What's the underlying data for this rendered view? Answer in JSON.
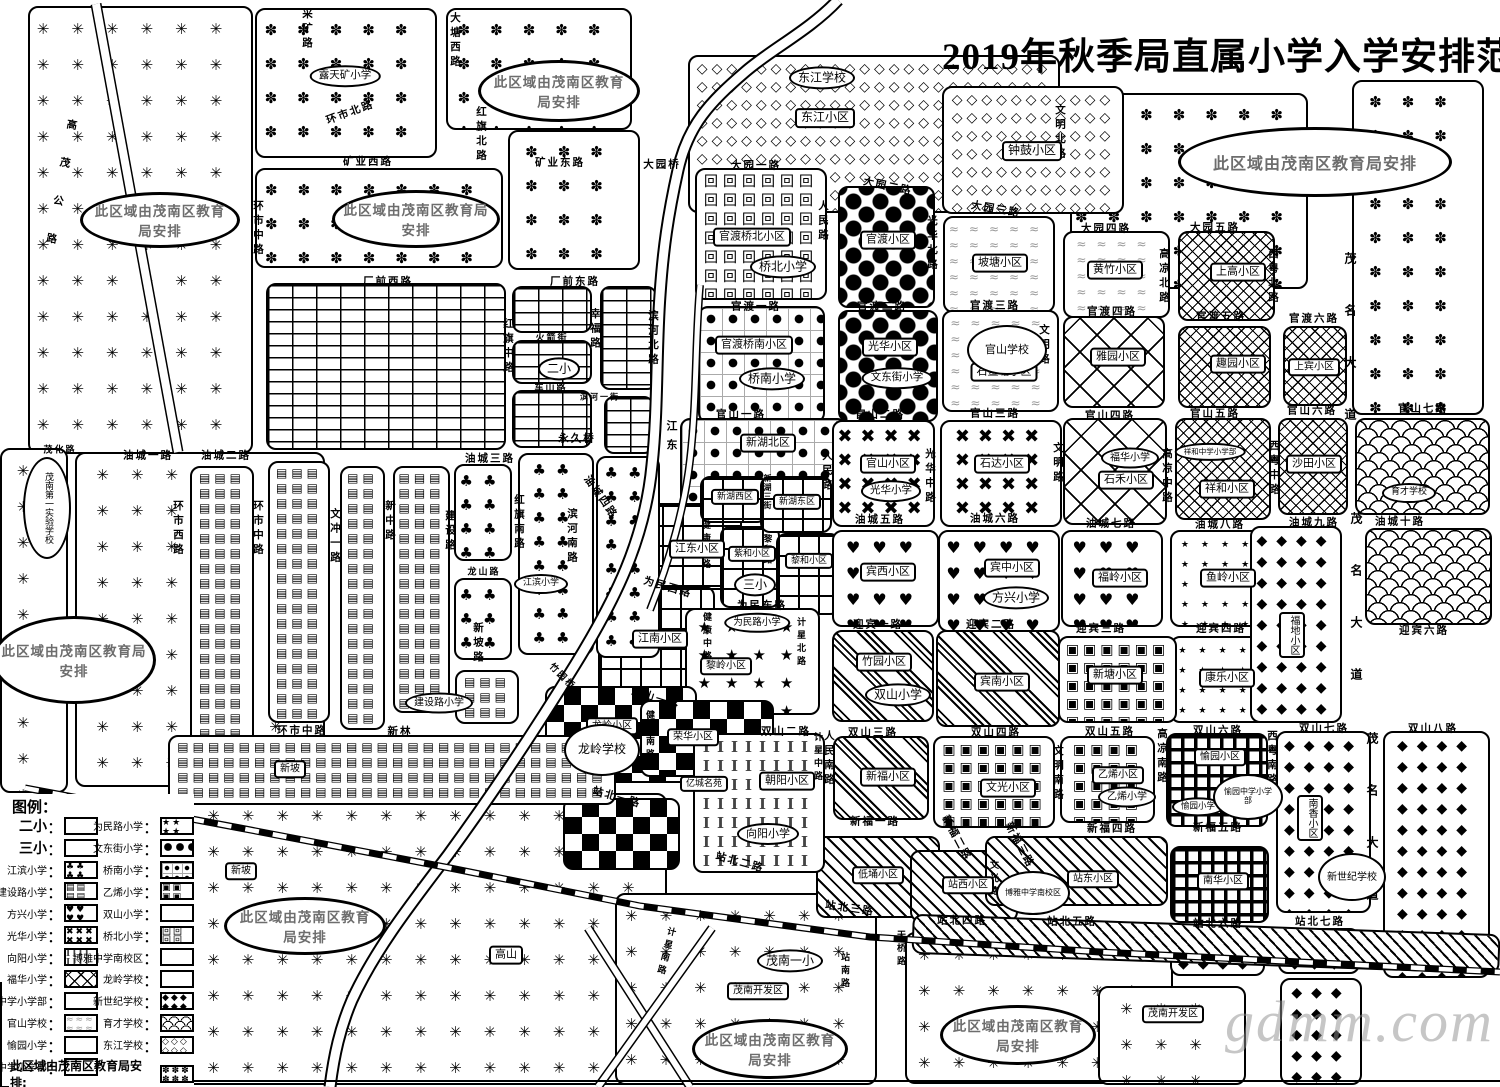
{
  "title": "2019年秋季局直属小学入学安排范围图",
  "watermark": "gdmm.com",
  "district_note": "此区域由茂南区教育局安排",
  "legend": {
    "title": "图例：",
    "colon": "：",
    "footer": "此区域由茂南区教育局安排:",
    "left": [
      {
        "label": "二小",
        "pattern": "brick"
      },
      {
        "label": "三小",
        "pattern": "grid-plaid"
      },
      {
        "label": "江滨小学",
        "pattern": "maple-club"
      },
      {
        "label": "建设路小学",
        "pattern": "bar-blocks"
      },
      {
        "label": "方兴小学",
        "pattern": "hearts"
      },
      {
        "label": "光华小学",
        "pattern": "crosses"
      },
      {
        "label": "向阳小学",
        "pattern": "i-beam"
      },
      {
        "label": "福华小学",
        "pattern": "diamond-lattice"
      },
      {
        "label": "祥和中学小学部",
        "pattern": "dense-crosshatch"
      },
      {
        "label": "官山学校",
        "pattern": "wiggle"
      },
      {
        "label": "愉园小学",
        "pattern": "basket-weave"
      },
      {
        "label": "愉园中学小学部",
        "pattern": "small-dots"
      }
    ],
    "right": [
      {
        "label": "为民路小学",
        "pattern": "stars"
      },
      {
        "label": "文东街小学",
        "pattern": "big-dots"
      },
      {
        "label": "桥南小学",
        "pattern": "octagon-dots"
      },
      {
        "label": "乙烯小学",
        "pattern": "concentric-squares"
      },
      {
        "label": "双山小学",
        "pattern": "group-stripes"
      },
      {
        "label": "桥北小学",
        "pattern": "greek-key"
      },
      {
        "label": "博雅中学南校区",
        "pattern": "diagonal-hatch"
      },
      {
        "label": "龙岭学校",
        "pattern": "checkerboard"
      },
      {
        "label": "新世纪学校",
        "pattern": "black-diamonds"
      },
      {
        "label": "育才学校",
        "pattern": "fish-scales"
      },
      {
        "label": "东江学校",
        "pattern": "circle-chain"
      }
    ]
  },
  "ovals": [
    "露天矿小学",
    "东江学校",
    "桥北小学",
    "桥南小学",
    "文东街小学",
    "官山学校",
    "二小",
    "三小",
    "光华小学",
    "福华小学",
    "祥和中学小学部",
    "育才学校",
    "江滨小学",
    "建设路小学",
    "为民路小学",
    "方兴小学",
    "双山小学",
    "龙岭学校",
    "向阳小学",
    "茂南一小",
    "乙烯小学",
    "愉园小学",
    "愉园中学小学部",
    "新世纪学校",
    "博雅中学南校区",
    "茂南第一实验学校"
  ],
  "blocks": [
    "东江小区",
    "钟鼓小区",
    "官渡桥北小区",
    "官渡小区",
    "坡塘小区",
    "黄竹小区",
    "上高小区",
    "官渡桥南小区",
    "光华小区",
    "石鳌塘小区",
    "雅园小区",
    "趣园小区",
    "上宾小区",
    "新湖北区",
    "新湖西区",
    "新湖东区",
    "官山小区",
    "石达小区",
    "石禾小区",
    "祥和小区",
    "沙田小区",
    "江东小区",
    "江南小区",
    "紫和小区",
    "黎和小区",
    "宾西小区",
    "宾中小区",
    "福岭小区",
    "鱼岭小区",
    "福地小区",
    "竹园小区",
    "宾南小区",
    "新塘小区",
    "康乐小区",
    "龙岭小区",
    "荣华小区",
    "亿城名苑",
    "朝阳小区",
    "新福小区",
    "文光小区",
    "乙烯小区",
    "愉园小区",
    "南香小区",
    "低埇小区",
    "站西小区",
    "站东小区",
    "南华小区",
    "新坡",
    "新坡",
    "高山",
    "茂南开发区",
    "茂南开发区",
    "黎岭小区"
  ],
  "roads": [
    "矿业西路",
    "矿业东路",
    "大园桥",
    "大园一路",
    "大园二路",
    "大园三路",
    "大园四路",
    "大园五路",
    "官渡一路",
    "官渡二路",
    "官渡三路",
    "官渡四路",
    "官渡五路",
    "官渡六路",
    "厂前西路",
    "厂前东路",
    "火箭街",
    "车山路",
    "滨河一街",
    "官山一路",
    "官山二路",
    "官山三路",
    "官山四路",
    "官山五路",
    "官山六路",
    "官山七路",
    "油城一路",
    "油城二路",
    "油城三路",
    "油城四路",
    "油城五路",
    "油城六路",
    "油城七路",
    "油城八路",
    "油城九路",
    "油城十路",
    "为民西路",
    "为民东路",
    "迎宾一路",
    "迎宾二路",
    "迎宾三路",
    "迎宾四路",
    "迎宾六路",
    "双山一路",
    "双山二路",
    "双山三路",
    "双山四路",
    "双山五路",
    "双山六路",
    "双山七路",
    "双山八路",
    "新福一路",
    "新福二路",
    "新福三路",
    "新福四路",
    "新福五路",
    "站北一路",
    "站北二路",
    "站北三路",
    "站北四路",
    "站北五路",
    "站北六路",
    "站北七路",
    "永久桥",
    "环市中路",
    "新林",
    "龙山路",
    "茂化路",
    "竹园桥",
    "环市北路"
  ],
  "vroads": [
    "高茂公路",
    "采矿路",
    "大塘西路",
    "红旗北路",
    "红旗中路",
    "红旗南路",
    "幸福路",
    "滨河北路",
    "滨河南路",
    "环市西路",
    "环市中路",
    "环市中路",
    "文冲一路",
    "新中路",
    "建设路",
    "新坡路",
    "人民路",
    "人民路",
    "人民南路",
    "光华北路",
    "光华中路",
    "文明北路",
    "文明路",
    "文明路",
    "文明南路",
    "高凉北路",
    "高凉中路",
    "高凉南路",
    "西粤北路",
    "西粤中路",
    "西粤南路",
    "茂名大道",
    "茂名大道",
    "茂名大道",
    "健康北路",
    "健康中路",
    "健康南路",
    "黎和路",
    "新湖三街",
    "计星北路",
    "计星中路",
    "计星南路",
    "站南路",
    "天桥路",
    "文光路",
    "江东"
  ]
}
